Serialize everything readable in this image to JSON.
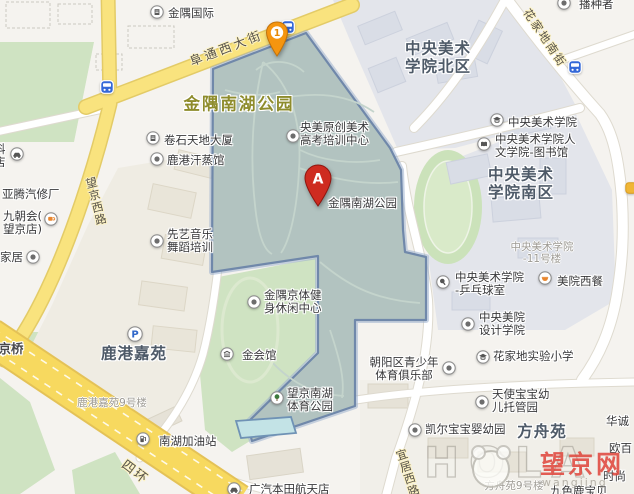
{
  "region": {
    "name": "金隅南湖公园",
    "marker_caption": "金隅南湖公园"
  },
  "colors": {
    "park_fill": "#b2c3c0",
    "park_border": "#7088aa",
    "park_glow": "#9db1cd",
    "road_yellow": "#f9e37e",
    "highway_yellow": "#f7d95f",
    "green_area": "#cfe3c2",
    "campus_area": "#e3e5eb",
    "marker_red": "#ce2b20",
    "marker_orange": "#f5950f",
    "bus_blue": "#3468d8",
    "park_label_olive": "#8e8c2c"
  },
  "area_labels": [
    {
      "lines": [
        "金隅南湖公园"
      ],
      "x": 239,
      "y": 104,
      "cls": "park-name"
    },
    {
      "lines": [
        "中央美术",
        "学院北区"
      ],
      "x": 438,
      "y": 58,
      "cls": ""
    },
    {
      "lines": [
        "中央美术",
        "学院南区"
      ],
      "x": 521,
      "y": 184,
      "cls": ""
    },
    {
      "lines": [
        "鹿港嘉苑"
      ],
      "x": 134,
      "y": 354,
      "cls": ""
    },
    {
      "lines": [
        "方舟苑"
      ],
      "x": 542,
      "y": 432,
      "cls": ""
    }
  ],
  "sub_labels": [
    {
      "lines": [
        "鹿港嘉苑9号楼"
      ],
      "x": 112,
      "y": 397
    },
    {
      "lines": [
        "中央美术学院",
        "-11号楼"
      ],
      "x": 542,
      "y": 241
    },
    {
      "lines": [
        "方舟苑9号楼"
      ],
      "x": 514,
      "y": 480
    }
  ],
  "road_labels": [
    {
      "text": "阜通西大街",
      "x": 226,
      "y": 47,
      "rot": -21,
      "size": 12.5,
      "ls": 3,
      "vertical": false
    },
    {
      "text": "花家地南街",
      "x": 545,
      "y": 38,
      "rot": 56,
      "size": 11.5,
      "ls": 2,
      "vertical": false
    },
    {
      "text": "四环",
      "x": 136,
      "y": 471,
      "rot": 37,
      "size": 13,
      "ls": 2,
      "vertical": false
    },
    {
      "text": "望京西路",
      "x": 82,
      "y": 177,
      "rot": -14,
      "size": 11.5,
      "ls": 1,
      "vertical": true
    },
    {
      "text": "宜居西路",
      "x": 392,
      "y": 449,
      "rot": -18,
      "size": 11.5,
      "ls": 1,
      "vertical": true
    }
  ],
  "pois": [
    {
      "icon": "building-icon",
      "ix": 150,
      "iy": 5,
      "lines": [
        "金隅国际"
      ],
      "tx": 168,
      "ty": 7
    },
    {
      "icon": "building-icon",
      "ix": 146,
      "iy": 131,
      "lines": [
        "卷石天地大厦"
      ],
      "tx": 164,
      "ty": 134
    },
    {
      "icon": "generic-poi-icon",
      "ix": 150,
      "iy": 152,
      "lines": [
        "鹿港汗蒸馆"
      ],
      "tx": 167,
      "ty": 154
    },
    {
      "icon": "generic-poi-icon",
      "ix": 286,
      "iy": 129,
      "lines": [
        "央美原创美术",
        "高考培训中心"
      ],
      "tx": 300,
      "ty": 121
    },
    {
      "icon": "school-icon",
      "ix": 490,
      "iy": 113,
      "lines": [
        "中央美术学院"
      ],
      "tx": 508,
      "ty": 116
    },
    {
      "icon": "library-icon",
      "ix": 477,
      "iy": 137,
      "lines": [
        "中央美术学院人",
        "文学院-图书馆"
      ],
      "tx": 495,
      "ty": 133
    },
    {
      "icon": "pingpong-icon",
      "ix": 436,
      "iy": 275,
      "lines": [
        "中央美术学院",
        "-乒乓球室"
      ],
      "tx": 455,
      "ty": 271
    },
    {
      "icon": "restaurant-icon",
      "ix": 538,
      "iy": 271,
      "lines": [
        "美院西餐"
      ],
      "tx": 557,
      "ty": 275
    },
    {
      "icon": "generic-poi-icon",
      "ix": 461,
      "iy": 317,
      "lines": [
        "中央美院",
        "设计学院"
      ],
      "tx": 479,
      "ty": 311
    },
    {
      "icon": "school-icon",
      "ix": 476,
      "iy": 350,
      "lines": [
        "花家地实验小学"
      ],
      "tx": 493,
      "ty": 350
    },
    {
      "icon": "generic-poi-icon",
      "ix": 442,
      "iy": 361,
      "lines": [
        "朝阳区青少年",
        "体育俱乐部"
      ],
      "tx": 366,
      "ty": 356,
      "w": 76,
      "ta": "center"
    },
    {
      "icon": "generic-poi-icon",
      "ix": 475,
      "iy": 395,
      "lines": [
        "天使宝宝幼",
        "儿托管园"
      ],
      "tx": 492,
      "ty": 388
    },
    {
      "icon": "generic-poi-icon",
      "ix": 408,
      "iy": 423,
      "lines": [
        "凯尔宝宝婴幼园"
      ],
      "tx": 425,
      "ty": 423
    },
    {
      "icon": "generic-poi-icon",
      "ix": 247,
      "iy": 295,
      "lines": [
        "金隅京体健",
        "身休闲中心"
      ],
      "tx": 264,
      "ty": 289
    },
    {
      "icon": "museum-icon",
      "ix": 220,
      "iy": 347,
      "lines": [
        "金会馆"
      ],
      "tx": 242,
      "ty": 349
    },
    {
      "icon": "tree-icon",
      "ix": 270,
      "iy": 391,
      "lines": [
        "望京南湖",
        "体育公园"
      ],
      "tx": 287,
      "ty": 387
    },
    {
      "icon": "generic-poi-icon",
      "ix": 150,
      "iy": 234,
      "lines": [
        "先艺音乐",
        "舞蹈培训"
      ],
      "tx": 167,
      "ty": 228
    },
    {
      "icon": "coffee-icon",
      "ix": 44,
      "iy": 212,
      "lines": [
        "九朝会(",
        "望京店)"
      ],
      "tx": 3,
      "ty": 210
    },
    {
      "icon": null,
      "lines": [
        "亚腾汽修厂"
      ],
      "tx": 2,
      "ty": 188
    },
    {
      "icon": "generic-poi-icon",
      "ix": 26,
      "iy": 250,
      "lines": [
        "家居"
      ],
      "tx": 0,
      "ty": 251
    },
    {
      "icon": "gas-icon",
      "ix": 136,
      "iy": 432,
      "lines": [
        "南湖加油站"
      ],
      "tx": 159,
      "ty": 435
    },
    {
      "icon": "car-icon",
      "ix": 227,
      "iy": 482,
      "lines": [
        "广汽本田航天店"
      ],
      "tx": 249,
      "ty": 483
    },
    {
      "icon": "car-icon",
      "ix": 10,
      "iy": 147,
      "lines": [
        "科",
        "店"
      ],
      "tx": -6,
      "ty": 143
    },
    {
      "icon": "generic-poi-icon",
      "ix": 557,
      "iy": -4,
      "lines": [
        "播种者"
      ],
      "tx": 579,
      "ty": -2
    },
    {
      "icon": "bus-icon",
      "ix": 100,
      "iy": 80,
      "lines": []
    },
    {
      "icon": "bus-icon",
      "ix": 281,
      "iy": 20,
      "lines": []
    },
    {
      "icon": "bus-icon",
      "ix": 568,
      "iy": 60,
      "lines": []
    },
    {
      "icon": "parking-icon",
      "ix": 127,
      "iy": 326,
      "lines": []
    },
    {
      "icon": "yellow-poi-icon",
      "ix": 625,
      "iy": 182,
      "lines": []
    },
    {
      "icon": null,
      "lines": [
        "金隅南湖公园"
      ],
      "tx": 328,
      "ty": 197
    },
    {
      "icon": null,
      "lines": [
        "华诚"
      ],
      "tx": 606,
      "ty": 415
    },
    {
      "icon": null,
      "lines": [
        "欧百"
      ],
      "tx": 609,
      "ty": 442
    },
    {
      "icon": null,
      "lines": [
        "时尚"
      ],
      "tx": 603,
      "ty": 470
    },
    {
      "icon": null,
      "lines": [
        "九色鹿宝贝"
      ],
      "tx": 550,
      "ty": 485
    },
    {
      "icon": null,
      "lines": [
        "望京桥"
      ],
      "tx": -14,
      "ty": 342,
      "cls": "bridge"
    }
  ],
  "markers": {
    "a": {
      "letter": "A",
      "tip_x": 318,
      "tip_y": 207
    },
    "one": {
      "number": "1",
      "tip_x": 277,
      "tip_y": 56
    }
  },
  "watermark": {
    "ghost": "HOLA",
    "cn": "望京网",
    "en": "wangjing"
  }
}
